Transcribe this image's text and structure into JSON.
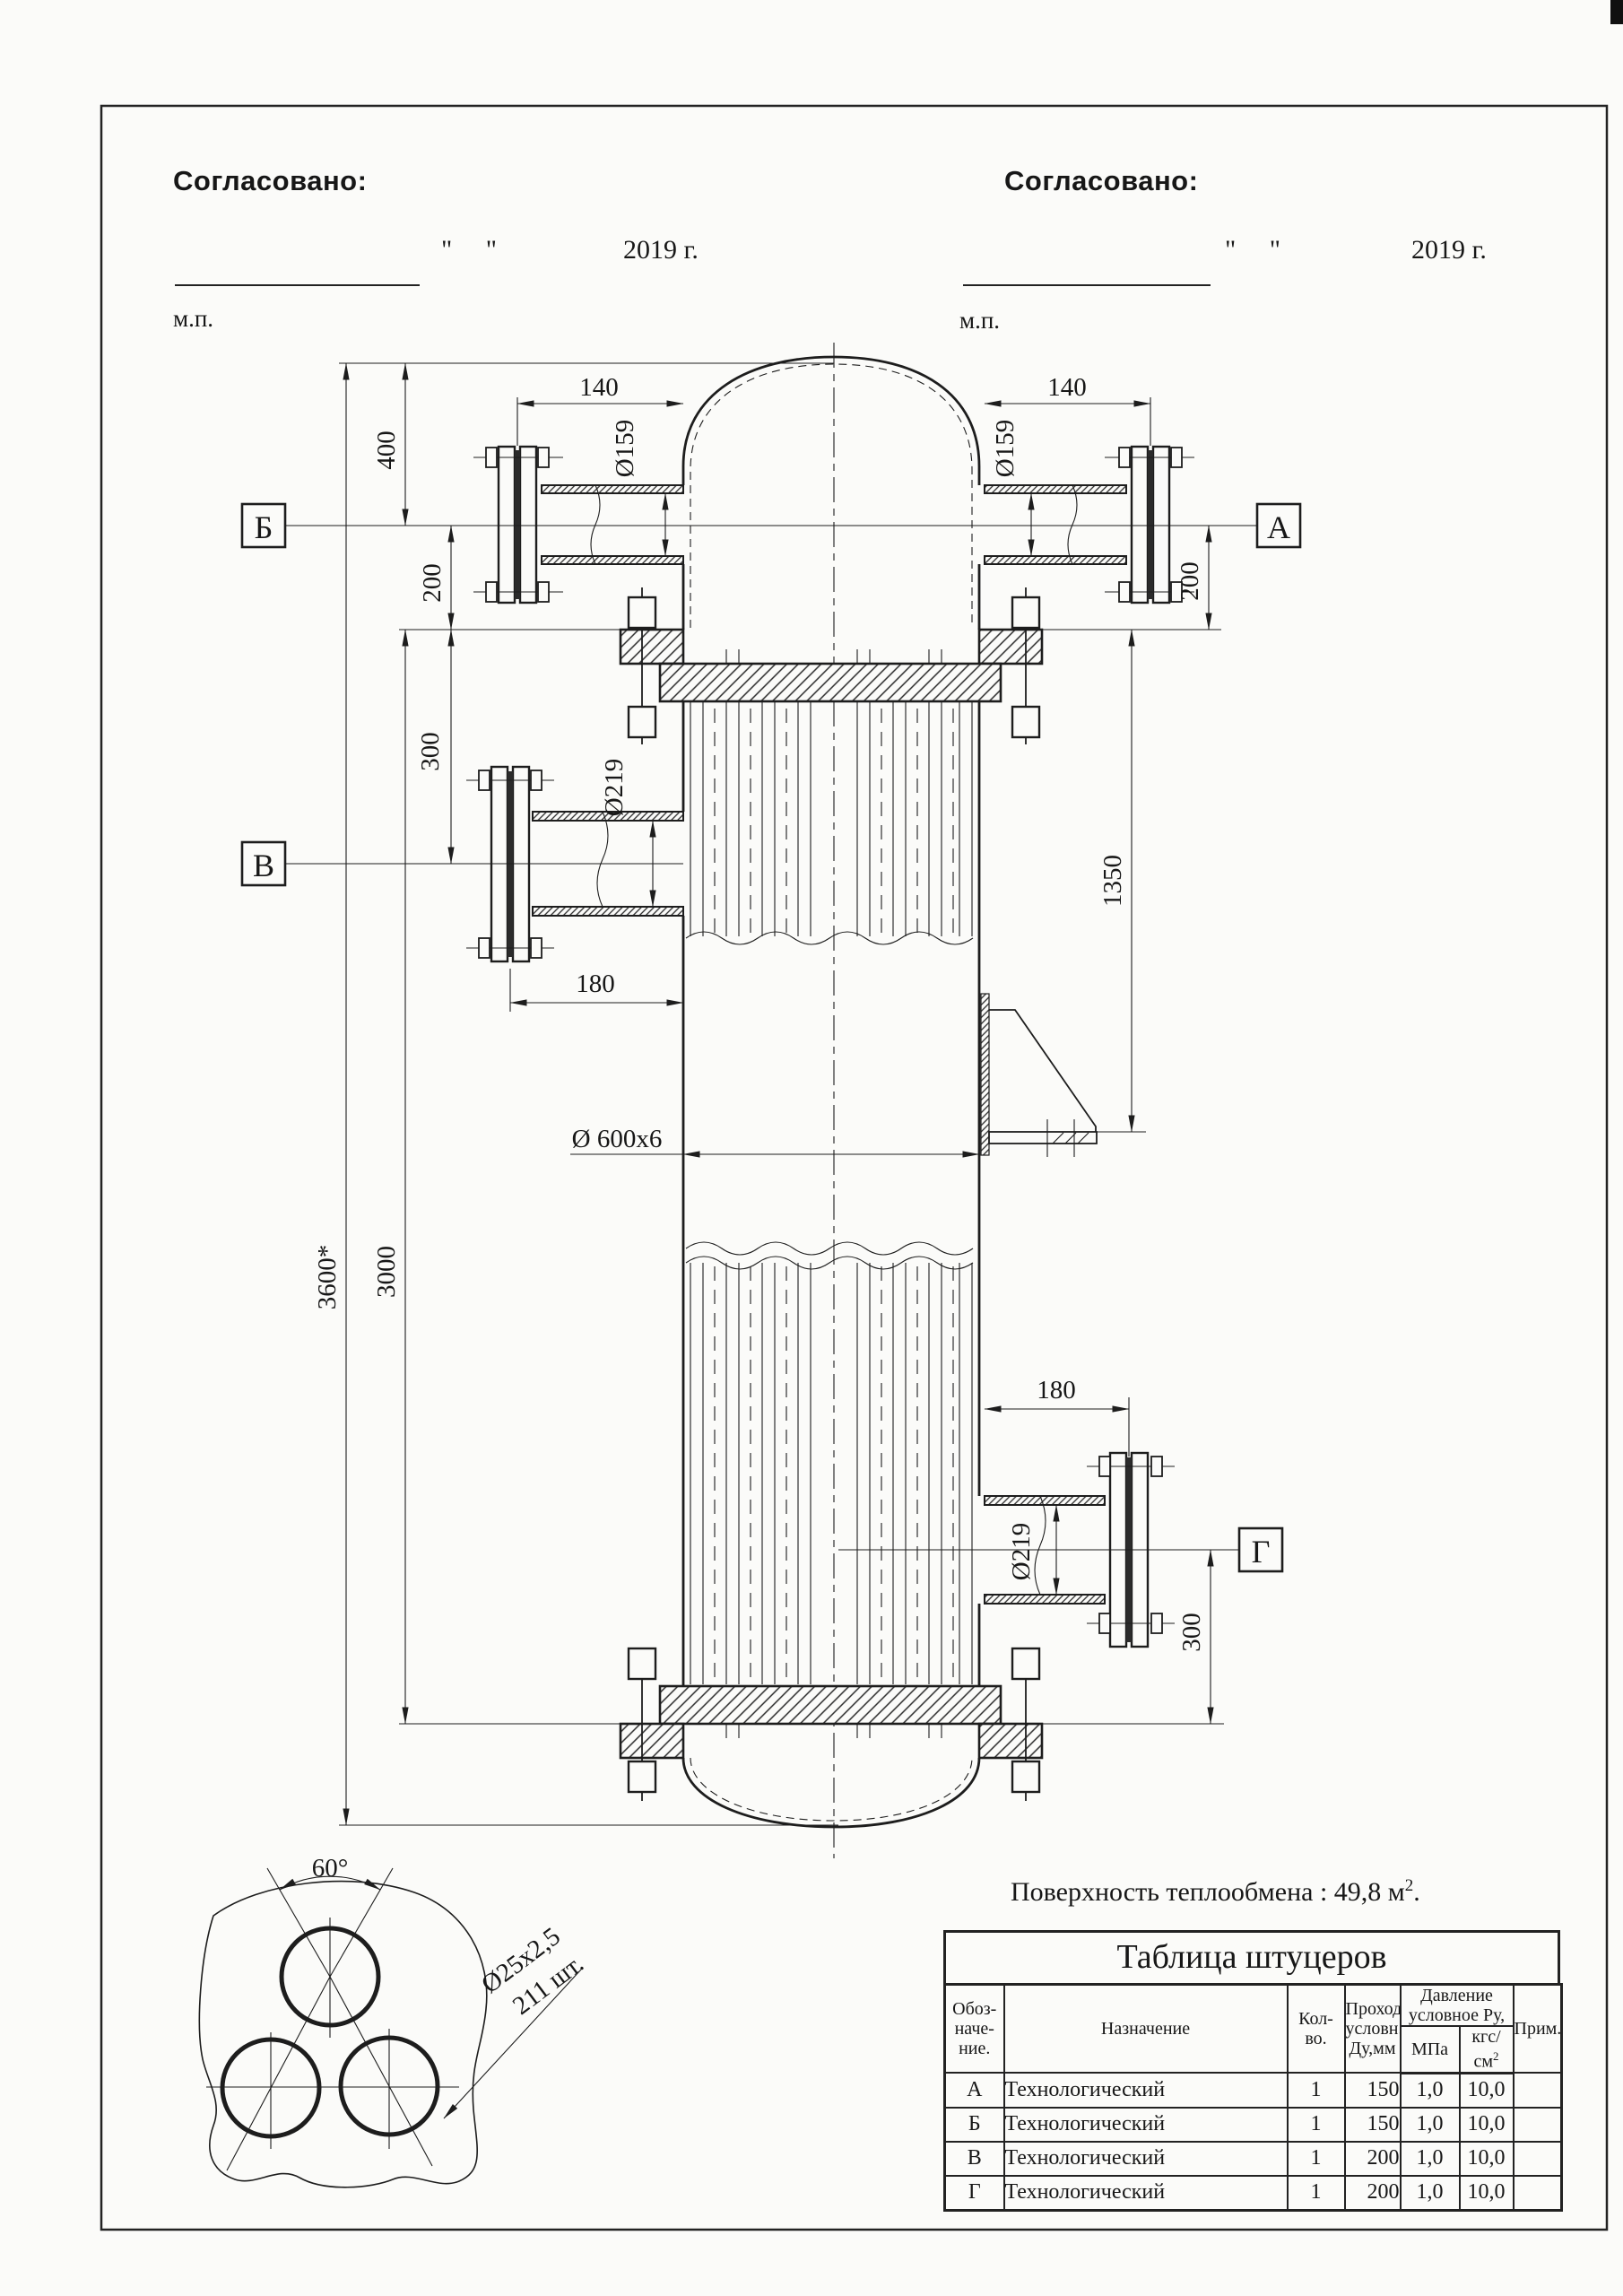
{
  "approval": {
    "title": "Согласовано:",
    "quotes": "\"     \"",
    "year": "2019 г.",
    "stamp": "м.п."
  },
  "sections": {
    "a": "А",
    "b": "Б",
    "v": "В",
    "g": "Г"
  },
  "dims": {
    "d140_left": "140",
    "d140_right": "140",
    "d159_left": "Ø159",
    "d159_right": "Ø159",
    "d400": "400",
    "d200_left": "200",
    "d200_right": "200",
    "d300_left": "300",
    "d300_right": "300",
    "d219_top": "Ø219",
    "d219_bottom": "Ø219",
    "d1350": "1350",
    "d180_left": "180",
    "d180_right": "180",
    "d600": "Ø 600x6",
    "d3600": "3600*",
    "d3000": "3000",
    "d60": "60°",
    "d25": "Ø25x2,5",
    "d211": "211 шт."
  },
  "note": {
    "text": "Поверхность теплообмена : 49,8 м",
    "sup": "2",
    "tail": "."
  },
  "table": {
    "title": "Таблица штуцеров",
    "h_designation": [
      "Обоз-",
      "наче-",
      "ние."
    ],
    "h_purpose": "Назначение",
    "h_qty": [
      "Кол-",
      "во."
    ],
    "h_bore": [
      "Проход",
      "условн.",
      "Ду,мм"
    ],
    "h_pressure": [
      "Давление",
      "условное Ру,"
    ],
    "h_mpa": "МПа",
    "h_kgs": "кгс/см",
    "h_kgs_sup": "2",
    "h_note": "Прим.",
    "rows": [
      [
        "А",
        "Технологический",
        "1",
        "150",
        "1,0",
        "10,0",
        ""
      ],
      [
        "Б",
        "Технологический",
        "1",
        "150",
        "1,0",
        "10,0",
        ""
      ],
      [
        "В",
        "Технологический",
        "1",
        "200",
        "1,0",
        "10,0",
        ""
      ],
      [
        "Г",
        "Технологический",
        "1",
        "200",
        "1,0",
        "10,0",
        ""
      ]
    ]
  }
}
